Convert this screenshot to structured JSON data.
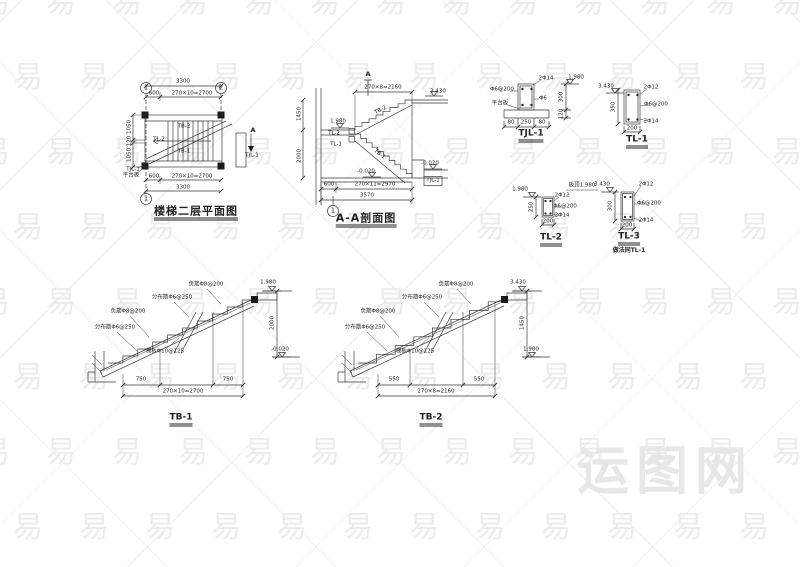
{
  "palette": {
    "ink": "#3a3a3a",
    "watermark": "#ececec",
    "brand": "#e7e7e7",
    "paper": "#ffffff"
  },
  "watermark": {
    "char": "易",
    "brand": "运图网"
  },
  "titles": {
    "plan": "楼梯二层平面图",
    "section": "A-A剖面图",
    "tjl1": "TJL-1",
    "tl1": "TL-1",
    "tl2": "TL-2",
    "tl3": "TL-3",
    "tb1": "TB-1",
    "tb2": "TB-2"
  },
  "annotations": [
    {
      "x": 146,
      "y": 88,
      "t": "1",
      "c": "ax"
    },
    {
      "x": 221,
      "y": 88,
      "t": "2",
      "c": "ax"
    },
    {
      "x": 146,
      "y": 199,
      "t": "1",
      "c": "ax"
    },
    {
      "x": 183,
      "y": 82,
      "t": "3300",
      "c": "d"
    },
    {
      "x": 154,
      "y": 94,
      "t": "600",
      "c": "d"
    },
    {
      "x": 192,
      "y": 94,
      "t": "270×10=2700",
      "c": "d"
    },
    {
      "x": 154,
      "y": 177,
      "t": "600",
      "c": "d"
    },
    {
      "x": 192,
      "y": 177,
      "t": "270×10=2700",
      "c": "d"
    },
    {
      "x": 183,
      "y": 188,
      "t": "3300",
      "c": "d"
    },
    {
      "x": 130,
      "y": 127,
      "t": "1050",
      "c": "d",
      "r": -90
    },
    {
      "x": 130,
      "y": 141,
      "t": "120",
      "c": "d",
      "r": -90
    },
    {
      "x": 130,
      "y": 155,
      "t": "1050",
      "c": "d",
      "r": -90
    },
    {
      "x": 184,
      "y": 127,
      "t": "TB-2",
      "c": "r"
    },
    {
      "x": 159,
      "y": 140,
      "t": "TL-2",
      "c": "r"
    },
    {
      "x": 184,
      "y": 152,
      "t": "TB-1",
      "c": "r"
    },
    {
      "x": 253,
      "y": 130,
      "t": "A",
      "c": "d6"
    },
    {
      "x": 252,
      "y": 156,
      "t": "TJL-1",
      "c": "r"
    },
    {
      "x": 133,
      "y": 170,
      "t": "TJL-1",
      "c": "r"
    },
    {
      "x": 131,
      "y": 176,
      "t": "平台板",
      "c": "r"
    },
    {
      "x": 196,
      "y": 213,
      "t": "楼梯二层平面图",
      "c": "bigtitle"
    },
    {
      "x": 333,
      "y": 211,
      "t": "1",
      "c": "ax"
    },
    {
      "x": 368,
      "y": 74,
      "t": "A",
      "c": "d6"
    },
    {
      "x": 438,
      "y": 92,
      "t": "3.430",
      "c": "l"
    },
    {
      "x": 338,
      "y": 122,
      "t": "1.980",
      "c": "l"
    },
    {
      "x": 334,
      "y": 134,
      "t": "TL-2",
      "c": "r"
    },
    {
      "x": 336,
      "y": 145,
      "t": "TL-1",
      "c": "r"
    },
    {
      "x": 383,
      "y": 88,
      "t": "270×8=2160",
      "c": "d"
    },
    {
      "x": 381,
      "y": 111,
      "t": "TB-2",
      "c": "r",
      "r": -27
    },
    {
      "x": 379,
      "y": 155,
      "t": "TB-1",
      "c": "r",
      "r": 38
    },
    {
      "x": 366,
      "y": 172,
      "t": "-0.020",
      "c": "l"
    },
    {
      "x": 430,
      "y": 164,
      "t": "-0.020",
      "c": "l"
    },
    {
      "x": 433,
      "y": 181,
      "t": "TJL-1",
      "c": "r"
    },
    {
      "x": 300,
      "y": 114,
      "t": "1450",
      "c": "d",
      "r": -90
    },
    {
      "x": 300,
      "y": 156,
      "t": "2000",
      "c": "d",
      "r": -90
    },
    {
      "x": 329,
      "y": 185,
      "t": "600",
      "c": "d"
    },
    {
      "x": 375,
      "y": 185,
      "t": "270×11=2970",
      "c": "d"
    },
    {
      "x": 367,
      "y": 196,
      "t": "3570",
      "c": "d"
    },
    {
      "x": 366,
      "y": 220,
      "t": "A-A剖面图",
      "c": "bigtitle"
    },
    {
      "x": 546,
      "y": 79,
      "t": "2Φ14",
      "c": "r"
    },
    {
      "x": 502,
      "y": 90,
      "t": "Φ6@200",
      "c": "r"
    },
    {
      "x": 500,
      "y": 104,
      "t": "平台板",
      "c": "r"
    },
    {
      "x": 543,
      "y": 99,
      "t": "Φ6",
      "c": "r"
    },
    {
      "x": 511,
      "y": 123,
      "t": "80",
      "c": "d"
    },
    {
      "x": 526,
      "y": 123,
      "t": "250",
      "c": "d"
    },
    {
      "x": 542,
      "y": 123,
      "t": "80",
      "c": "d"
    },
    {
      "x": 576,
      "y": 78,
      "t": "1.980",
      "c": "l"
    },
    {
      "x": 562,
      "y": 97,
      "t": "300",
      "c": "d",
      "r": -90
    },
    {
      "x": 562,
      "y": 114,
      "t": "120",
      "c": "d",
      "r": -90
    },
    {
      "x": 531,
      "y": 136,
      "t": "TJL-1",
      "c": "title"
    },
    {
      "x": 606,
      "y": 87,
      "t": "3.430",
      "c": "l"
    },
    {
      "x": 614,
      "y": 107,
      "t": "350",
      "c": "d",
      "r": -90
    },
    {
      "x": 651,
      "y": 88,
      "t": "2Φ12",
      "c": "r"
    },
    {
      "x": 656,
      "y": 105,
      "t": "Φ6@200",
      "c": "r"
    },
    {
      "x": 651,
      "y": 122,
      "t": "2Φ14",
      "c": "r"
    },
    {
      "x": 632,
      "y": 129,
      "t": "200",
      "c": "d"
    },
    {
      "x": 637,
      "y": 142,
      "t": "TL-1",
      "c": "title"
    },
    {
      "x": 520,
      "y": 190,
      "t": "1.980",
      "c": "l"
    },
    {
      "x": 582,
      "y": 186,
      "t": "板顶1.980",
      "c": "r"
    },
    {
      "x": 532,
      "y": 207,
      "t": "250",
      "c": "d",
      "r": -90
    },
    {
      "x": 562,
      "y": 196,
      "t": "2Φ12",
      "c": "r"
    },
    {
      "x": 565,
      "y": 207,
      "t": "Φ6@200",
      "c": "r"
    },
    {
      "x": 562,
      "y": 216,
      "t": "2Φ14",
      "c": "r"
    },
    {
      "x": 548,
      "y": 222,
      "t": "200",
      "c": "d"
    },
    {
      "x": 551,
      "y": 240,
      "t": "TL-2",
      "c": "title"
    },
    {
      "x": 602,
      "y": 185,
      "t": "3.430",
      "c": "l"
    },
    {
      "x": 611,
      "y": 206,
      "t": "300",
      "c": "d",
      "r": -90
    },
    {
      "x": 646,
      "y": 185,
      "t": "2Φ12",
      "c": "r"
    },
    {
      "x": 649,
      "y": 204,
      "t": "Φ6@200",
      "c": "r"
    },
    {
      "x": 646,
      "y": 221,
      "t": "2Φ14",
      "c": "r"
    },
    {
      "x": 627,
      "y": 226,
      "t": "200",
      "c": "d"
    },
    {
      "x": 629,
      "y": 239,
      "t": "TL-3",
      "c": "title"
    },
    {
      "x": 629,
      "y": 251,
      "t": "做法同TL-1",
      "c": "note"
    },
    {
      "x": 268,
      "y": 283,
      "t": "1.980",
      "c": "l"
    },
    {
      "x": 280,
      "y": 350,
      "t": "-0.020",
      "c": "l"
    },
    {
      "x": 273,
      "y": 323,
      "t": "2000",
      "c": "d",
      "r": -90
    },
    {
      "x": 141,
      "y": 380,
      "t": "750",
      "c": "d"
    },
    {
      "x": 228,
      "y": 380,
      "t": "750",
      "c": "d"
    },
    {
      "x": 183,
      "y": 392,
      "t": "270×10=2700",
      "c": "d"
    },
    {
      "x": 181,
      "y": 420,
      "t": "TB-1",
      "c": "title"
    },
    {
      "x": 206,
      "y": 285,
      "t": "负筋Φ8@200",
      "c": "r"
    },
    {
      "x": 172,
      "y": 298,
      "t": "分布筋Φ6@250",
      "c": "r"
    },
    {
      "x": 128,
      "y": 312,
      "t": "负筋Φ8@200",
      "c": "r"
    },
    {
      "x": 115,
      "y": 328,
      "t": "分布筋Φ6@250",
      "c": "r"
    },
    {
      "x": 165,
      "y": 352,
      "t": "梯板Φ10@125",
      "c": "r"
    },
    {
      "x": 518,
      "y": 283,
      "t": "3.430",
      "c": "l"
    },
    {
      "x": 531,
      "y": 350,
      "t": "1.980",
      "c": "l"
    },
    {
      "x": 523,
      "y": 323,
      "t": "1450",
      "c": "d",
      "r": -90
    },
    {
      "x": 394,
      "y": 380,
      "t": "550",
      "c": "d"
    },
    {
      "x": 479,
      "y": 380,
      "t": "550",
      "c": "d"
    },
    {
      "x": 436,
      "y": 392,
      "t": "270×8=2160",
      "c": "d"
    },
    {
      "x": 431,
      "y": 420,
      "t": "TB-2",
      "c": "title"
    },
    {
      "x": 456,
      "y": 285,
      "t": "负筋Φ8@200",
      "c": "r"
    },
    {
      "x": 422,
      "y": 298,
      "t": "分布筋Φ6@250",
      "c": "r"
    },
    {
      "x": 378,
      "y": 312,
      "t": "负筋Φ8@200",
      "c": "r"
    },
    {
      "x": 365,
      "y": 328,
      "t": "分布筋Φ6@250",
      "c": "r"
    },
    {
      "x": 415,
      "y": 352,
      "t": "梯板Φ10@125",
      "c": "r"
    }
  ]
}
